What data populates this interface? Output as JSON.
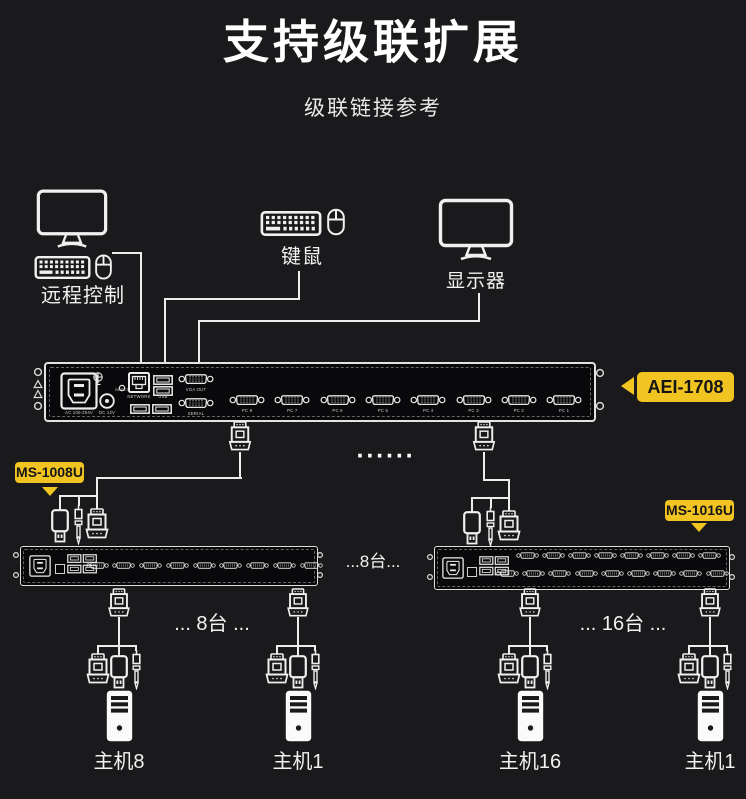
{
  "colors": {
    "background": "#1a1a1c",
    "line": "#ededed",
    "accent_yellow": "#f2c422",
    "badge_text": "#151515"
  },
  "header": {
    "title": "支持级联扩展",
    "subtitle": "级联链接参考"
  },
  "peripherals": {
    "remote_label": "远程控制",
    "keyboard_mouse_label": "键鼠",
    "monitor_label": "显示器"
  },
  "main_switch": {
    "badge": "AEI-1708",
    "power_label": "AC 100-264V",
    "dc_label": "DC 12V",
    "reset_label": "RESET",
    "network_label": "NETWORK",
    "usb_label": "USB",
    "vga_out_label": "VGA OUT",
    "serial_label": "SERIAL",
    "pc_ports": [
      "PC 8",
      "PC 7",
      "PC 6",
      "PC 5",
      "PC 4",
      "PC 3",
      "PC 2",
      "PC 1"
    ]
  },
  "cascade": {
    "ellipsis_dots": "······",
    "left_badge": "MS-1008U",
    "right_badge": "MS-1016U",
    "left_inline_label": "...8台...",
    "left_group_label": "... 8台 ...",
    "right_group_label": "... 16台 ...",
    "left_switch_ports": 9,
    "right_switch_ports_top": 8,
    "right_switch_ports_bottom": 9
  },
  "hosts": {
    "labels": [
      "主机8",
      "主机1",
      "主机16",
      "主机1"
    ]
  }
}
